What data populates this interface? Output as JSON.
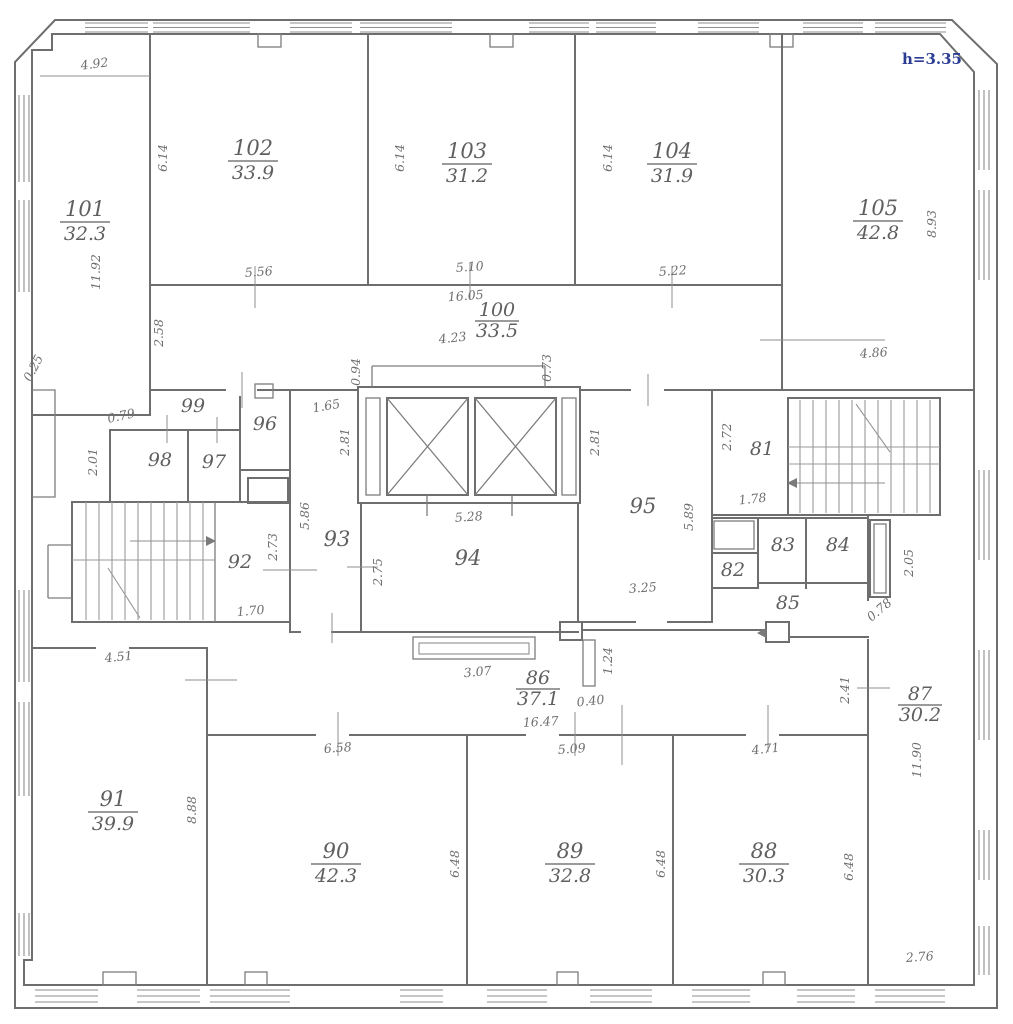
{
  "note": {
    "height_label": "h=3.35",
    "color": "#2b3c94"
  },
  "rooms": {
    "r101": {
      "number": "101",
      "area": "32.3"
    },
    "r102": {
      "number": "102",
      "area": "33.9"
    },
    "r103": {
      "number": "103",
      "area": "31.2"
    },
    "r104": {
      "number": "104",
      "area": "31.9"
    },
    "r105": {
      "number": "105",
      "area": "42.8"
    },
    "r100": {
      "number": "100",
      "area": "33.5"
    },
    "r99": {
      "number": "99"
    },
    "r98": {
      "number": "98"
    },
    "r97": {
      "number": "97"
    },
    "r96": {
      "number": "96"
    },
    "r95": {
      "number": "95"
    },
    "r94": {
      "number": "94"
    },
    "r93": {
      "number": "93"
    },
    "r92": {
      "number": "92"
    },
    "r91": {
      "number": "91",
      "area": "39.9"
    },
    "r90": {
      "number": "90",
      "area": "42.3"
    },
    "r89": {
      "number": "89",
      "area": "32.8"
    },
    "r88": {
      "number": "88",
      "area": "30.3"
    },
    "r87": {
      "number": "87",
      "area": "30.2"
    },
    "r86": {
      "number": "86",
      "area": "37.1"
    },
    "r85": {
      "number": "85"
    },
    "r84": {
      "number": "84"
    },
    "r83": {
      "number": "83"
    },
    "r82": {
      "number": "82"
    },
    "r81": {
      "number": "81"
    }
  },
  "dims": {
    "v4_92": "4.92",
    "v6_14": "6.14",
    "v11_92": "11.92",
    "v8_93": "8.93",
    "v5_56": "5.56",
    "v5_10": "5.10",
    "v5_22": "5.22",
    "v16_05": "16.05",
    "v4_23": "4.23",
    "v0_94": "0.94",
    "v0_73": "0.73",
    "v2_58": "2.58",
    "v0_25": "0.25",
    "v4_86": "4.86",
    "v0_79": "0.79",
    "v2_01": "2.01",
    "v1_65": "1.65",
    "v2_81": "2.81",
    "v2_72": "2.72",
    "v1_78": "1.78",
    "v5_89": "5.89",
    "v5_86": "5.86",
    "v5_28": "5.28",
    "v2_73": "2.73",
    "v2_75": "2.75",
    "v3_25": "3.25",
    "v2_05": "2.05",
    "v1_70": "1.70",
    "v0_78": "0.78",
    "v4_51": "4.51",
    "v3_07": "3.07",
    "v1_24": "1.24",
    "v0_40": "0.40",
    "v2_41": "2.41",
    "v16_47": "16.47",
    "v6_58": "6.58",
    "v5_09": "5.09",
    "v4_71": "4.71",
    "v11_90": "11.90",
    "v8_88": "8.88",
    "v6_48": "6.48",
    "v2_76": "2.76"
  }
}
